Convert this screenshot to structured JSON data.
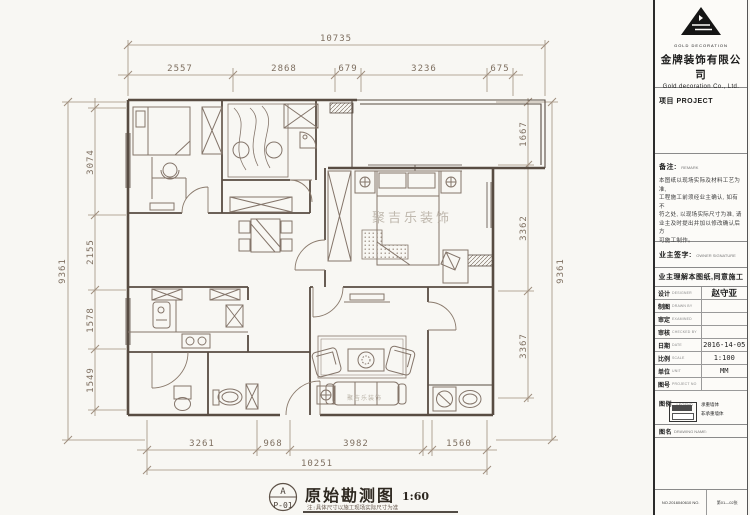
{
  "plan": {
    "title": "原始勘测图",
    "scale": "1:60",
    "sheet_letter": "A",
    "sheet_no": "P-01",
    "note": "注:具体尺寸以施工现场实际尺寸为准",
    "watermark": "聚吉乐装饰",
    "watermark_small": "聚吉乐装饰"
  },
  "dims": {
    "top_total": "10735",
    "top_segments": [
      "2557",
      "2868",
      "679",
      "3236",
      "675"
    ],
    "left_total": "9361",
    "left_segments": [
      "3074",
      "2155",
      "1578",
      "1549"
    ],
    "right_total": "9361",
    "right_segments": [
      "1667",
      "3362",
      "3367"
    ],
    "bottom_total": "10251",
    "bottom_segments": [
      "3261",
      "968",
      "3982",
      "1560"
    ]
  },
  "titleblock": {
    "logo_text": "GOLD DECORATION",
    "company_cn": "金牌装饰有限公司",
    "company_en": "Gold decoration Co., Ltd.",
    "project_label": "项目 PROJECT",
    "remark_label": "备注:",
    "remark_sub": "REMARK",
    "note_lines": [
      "本图纸以现场实际及材料工艺为准,",
      "工程施工前须经业主确认, 如有不",
      "符之处, 以现场实际尺寸为准, 请",
      "业主及时提出并加以修改确认后方",
      "可施工制作。"
    ],
    "owner_label": "业主签字:",
    "owner_sub": "OWNER SIGNATURE",
    "owner_statement": "业主理解本图纸,同意施工",
    "rows": [
      {
        "label": "设计",
        "sub": "DESIGNER",
        "value": "赵守亚"
      },
      {
        "label": "制图",
        "sub": "DRAWN BY",
        "value": ""
      },
      {
        "label": "审定",
        "sub": "EXAMINED",
        "value": ""
      },
      {
        "label": "审核",
        "sub": "CHECKED BY",
        "value": ""
      },
      {
        "label": "日期",
        "sub": "DATE",
        "value": "2016-14-05"
      },
      {
        "label": "比例",
        "sub": "SCALE",
        "value": "1:100"
      },
      {
        "label": "单位",
        "sub": "UNIT",
        "value": "MM"
      },
      {
        "label": "图号",
        "sub": "PROJECT NO",
        "value": ""
      }
    ],
    "legend_label": "图例",
    "legend_sub": "LEGEND",
    "legend_items": [
      "承重墙体",
      "非承重墙体"
    ],
    "drawing_name_label": "图名",
    "drawing_name_sub": "DRAWING NAME:",
    "footer_left": "NO.2016040610 NO.",
    "footer_right": "第01—02张"
  },
  "colors": {
    "wall_line": "#584c42",
    "furniture_line": "#84756a",
    "dimension_line": "#a08f7e",
    "dimension_text": "#7e6f60",
    "watermark": "#b6aea2",
    "titleblock_text": "#1c1c1c",
    "paper": "#f8f7f3"
  }
}
